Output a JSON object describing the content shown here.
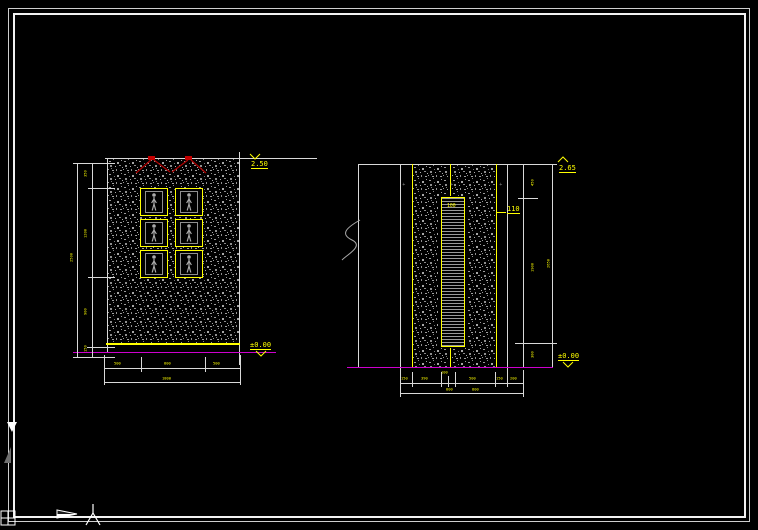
{
  "app": {
    "kind": "cad-viewport"
  },
  "colors": {
    "background": "#000000",
    "cad_yellow": "#ffff00",
    "cad_magenta": "#cd00cd",
    "cad_red": "#c40000",
    "line_white": "#d9d9d9",
    "hatch_gray": "#9a9a9a"
  },
  "left_elevation": {
    "level_top": "2.50",
    "level_bottom": "±0.00",
    "side_dims": [
      "350",
      "1200",
      "900",
      "150"
    ],
    "side_total": "2500",
    "bottom_dims": [
      "500",
      "800",
      "500"
    ],
    "bottom_total": "1800"
  },
  "right_section": {
    "level_top": "2.65",
    "level_bottom": "±0.00",
    "ladder_label": "100",
    "trim_label": "110",
    "side_dims": [
      "450",
      "1900",
      "300"
    ],
    "side_total": "2650",
    "bottom_dims": [
      "150",
      "390",
      "100",
      "500",
      "150",
      "200"
    ],
    "bottom_dims_row2": [
      "800",
      "800"
    ]
  }
}
